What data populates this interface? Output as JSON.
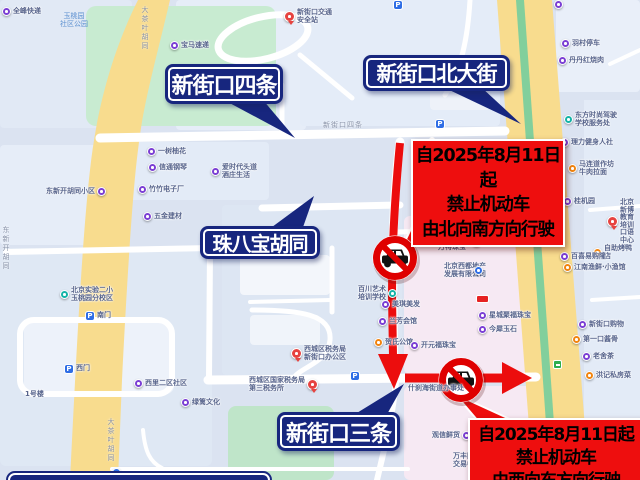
{
  "map": {
    "colors": {
      "background": "#dbe3f1",
      "road_yellow": "#f8dc8e",
      "road_green_stripe": "#82cf9c",
      "park_green": "#c8ebd1",
      "block_pink": "#f6e9f3",
      "sign_navy": "#17267e",
      "notice_red": "#ee0e0e",
      "arrow_red": "#ec0d0d",
      "prohibition_ring": "#df0000"
    },
    "street_sign_labels": [
      {
        "text": "新街口四条"
      },
      {
        "text": "新街口北大街"
      },
      {
        "text": "珠八宝胡同"
      },
      {
        "text": "新街口三条"
      }
    ],
    "notices": [
      {
        "line1": "自2025年8月11日起",
        "line2": "禁止机动车",
        "line3": "由北向南方向行驶"
      },
      {
        "line1": "自2025年8月11日起",
        "line2": "禁止机动车",
        "line3": "由西向东方向行驶"
      }
    ],
    "park_label": "玉桃园\n社区公园",
    "street_names_on_map": [
      {
        "text": "新街口四条",
        "x": 323,
        "y": 120,
        "vertical": false
      },
      {
        "text": "大茶叶胡同",
        "x": 140,
        "y": 6,
        "vertical": true
      },
      {
        "text": "大茶叶胡同",
        "x": 106,
        "y": 418,
        "vertical": true
      },
      {
        "text": "东新开胡同",
        "x": 1,
        "y": 226,
        "vertical": true
      }
    ],
    "icons": {
      "parking_glyph": "P"
    },
    "pois": [
      {
        "x": 7,
        "y": 12,
        "kind": "purple",
        "label": "全峰快递"
      },
      {
        "x": 175,
        "y": 46,
        "kind": "purple",
        "label": "宝马速递"
      },
      {
        "x": 289,
        "y": 14,
        "kind": "red",
        "label": "新街口交通\n安全站"
      },
      {
        "x": 559,
        "y": 5,
        "kind": "purple",
        "label": ""
      },
      {
        "x": 566,
        "y": 44,
        "kind": "purple",
        "label": "羽村停车"
      },
      {
        "x": 563,
        "y": 61,
        "kind": "purple",
        "label": "丹丹红烧肉"
      },
      {
        "x": 569,
        "y": 117,
        "kind": "teal",
        "label": "东方时尚驾驶\n学校服务处"
      },
      {
        "x": 565,
        "y": 143,
        "kind": "purple",
        "label": "理力健身人社"
      },
      {
        "x": 573,
        "y": 166,
        "kind": "orange",
        "label": "马连道作坊\n牛肉拉面"
      },
      {
        "x": 568,
        "y": 202,
        "kind": "purple",
        "label": "桂机园"
      },
      {
        "x": 612,
        "y": 204,
        "kind": "red",
        "label": "北京新博教育\n培训口语中心"
      },
      {
        "x": 598,
        "y": 250,
        "kind": "orange",
        "label": "自助烤鸭店"
      },
      {
        "x": 565,
        "y": 257,
        "kind": "purple",
        "label": "百喜易购隆"
      },
      {
        "x": 568,
        "y": 268,
        "kind": "orange",
        "label": "江南渔鲜·小渔馆"
      },
      {
        "x": 583,
        "y": 325,
        "kind": "purple",
        "label": "新街口购物"
      },
      {
        "x": 577,
        "y": 340,
        "kind": "orange",
        "label": "第一口酱骨"
      },
      {
        "x": 587,
        "y": 357,
        "kind": "purple",
        "label": "老舍茶"
      },
      {
        "x": 590,
        "y": 376,
        "kind": "orange",
        "label": "洪记私房菜"
      },
      {
        "x": 95,
        "y": 192,
        "kind": "purple",
        "label": "东新开胡同小区",
        "side": "left"
      },
      {
        "x": 152,
        "y": 152,
        "kind": "purple",
        "label": "一树柚花"
      },
      {
        "x": 153,
        "y": 168,
        "kind": "purple",
        "label": "信通钢琴"
      },
      {
        "x": 143,
        "y": 190,
        "kind": "purple",
        "label": "竹竹电子厂"
      },
      {
        "x": 148,
        "y": 217,
        "kind": "purple",
        "label": "五金建材"
      },
      {
        "x": 216,
        "y": 169,
        "kind": "purple",
        "label": "爱时代头道\n酒庄生活"
      },
      {
        "x": 65,
        "y": 292,
        "kind": "teal",
        "label": "北京实验二小\n玉桃园分校区"
      },
      {
        "x": 90,
        "y": 316,
        "kind": "parking",
        "label": "南门"
      },
      {
        "x": 69,
        "y": 369,
        "kind": "parking",
        "label": "西门"
      },
      {
        "x": 30,
        "y": 396,
        "kind": "text",
        "label": "1号楼"
      },
      {
        "x": 139,
        "y": 384,
        "kind": "purple",
        "label": "西里二区社区"
      },
      {
        "x": 186,
        "y": 403,
        "kind": "purple",
        "label": "绿篱文化"
      },
      {
        "x": 296,
        "y": 351,
        "kind": "red",
        "label": "西城区税务局\n新街口办公区"
      },
      {
        "x": 307,
        "y": 382,
        "kind": "red",
        "label": "西城区国家税务局\n第三税务所",
        "side": "left"
      },
      {
        "x": 386,
        "y": 291,
        "kind": "teal",
        "label": "百川艺术\n培训学校",
        "side": "left"
      },
      {
        "x": 386,
        "y": 305,
        "kind": "purple",
        "label": "美琪美发"
      },
      {
        "x": 383,
        "y": 322,
        "kind": "purple",
        "label": "兰芳会馆"
      },
      {
        "x": 379,
        "y": 343,
        "kind": "orange",
        "label": "贺氏公馆"
      },
      {
        "x": 355,
        "y": 376,
        "kind": "parking",
        "label": ""
      },
      {
        "x": 440,
        "y": 124,
        "kind": "parking",
        "label": ""
      },
      {
        "x": 398,
        "y": 5,
        "kind": "parking",
        "label": ""
      },
      {
        "x": 477,
        "y": 243,
        "kind": "blue",
        "label": "西门"
      },
      {
        "x": 443,
        "y": 249,
        "kind": "text",
        "label": "万特珠宝"
      },
      {
        "x": 449,
        "y": 268,
        "kind": "text",
        "label": "北京西都地产\n发展有限公司"
      },
      {
        "x": 479,
        "y": 271,
        "kind": "blue",
        "label": ""
      },
      {
        "x": 450,
        "y": 231,
        "kind": "blue",
        "label": "坤中培珠宝",
        "side": "left"
      },
      {
        "x": 481,
        "y": 300,
        "kind": "badge",
        "label": ""
      },
      {
        "x": 483,
        "y": 316,
        "kind": "purple",
        "label": "星城聚福珠宝"
      },
      {
        "x": 483,
        "y": 330,
        "kind": "purple",
        "label": "今犀玉石"
      },
      {
        "x": 415,
        "y": 346,
        "kind": "purple",
        "label": "开元福珠宝"
      },
      {
        "x": 413,
        "y": 390,
        "kind": "text",
        "label": "什刹海街道办事处"
      },
      {
        "x": 460,
        "y": 436,
        "kind": "purple",
        "label": "观信鲜货",
        "side": "left"
      },
      {
        "x": 458,
        "y": 458,
        "kind": "text",
        "label": "万丰国际\n交易中心"
      },
      {
        "x": 488,
        "y": 477,
        "kind": "orange",
        "label": ""
      },
      {
        "x": 558,
        "y": 365,
        "kind": "bus",
        "label": ""
      },
      {
        "x": 117,
        "y": 473,
        "kind": "blue",
        "label": ""
      }
    ]
  }
}
